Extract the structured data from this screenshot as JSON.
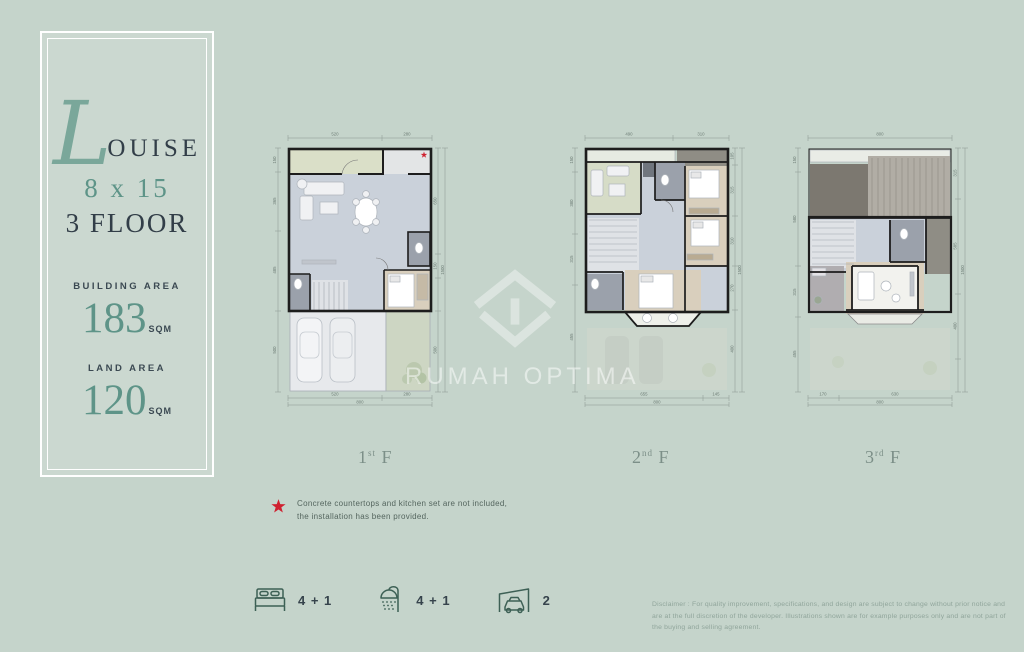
{
  "panel": {
    "title_initial": "L",
    "title_rest": "OUISE",
    "size": "8 x 15",
    "floors_line": "3 FLOOR",
    "building_area_label": "BUILDING AREA",
    "building_area_value": "183",
    "building_area_unit": "SQM",
    "land_area_label": "LAND AREA",
    "land_area_value": "120",
    "land_area_unit": "SQM"
  },
  "watermark": {
    "brand": "RUMAH OPTIMA"
  },
  "floors": [
    {
      "num": "1",
      "sup": "st",
      "f": "F",
      "dims": {
        "top": [
          "520",
          "280"
        ],
        "bottom": [
          "520",
          "280"
        ],
        "bottom_total": "800",
        "left": [
          "150",
          "365",
          "485",
          "500"
        ],
        "right": [
          "650",
          "150",
          "500"
        ],
        "right_total": "1500"
      }
    },
    {
      "num": "2",
      "sup": "nd",
      "f": "F",
      "dims": {
        "top": [
          "490",
          "310"
        ],
        "bottom": [
          "655",
          "145"
        ],
        "bottom_total": "800",
        "left": [
          "150",
          "380",
          "315",
          "455"
        ],
        "right": [
          "105",
          "315",
          "310",
          "270",
          "400"
        ],
        "right_total": "1500"
      }
    },
    {
      "num": "3",
      "sup": "rd",
      "f": "F",
      "dims": {
        "top": [
          "800"
        ],
        "bottom": [
          "170",
          "630"
        ],
        "bottom_total": "800",
        "left": [
          "150",
          "580",
          "315",
          "455"
        ],
        "right": [
          "315",
          "585",
          "400"
        ],
        "right_total": "1500"
      }
    }
  ],
  "footnote": {
    "line1": "Concrete countertops and kitchen set are not included,",
    "line2": "the installation has been provided."
  },
  "amenities": {
    "bed": "4 + 1",
    "shower": "4 + 1",
    "car": "2"
  },
  "disclaimer": "Disclaimer : For quality improvement, specifications, and design are subject to change without prior notice and are at the full discretion of the developer. Illustrations shown are for example purposes only and are not part of the buying and selling agreement.",
  "colors": {
    "background": "#c5d4cb",
    "accent_teal": "#5e9488",
    "dark_text": "#323e48",
    "wall": "#1d1d1d",
    "star_red": "#cf2130",
    "watermark_white": "rgba(255,255,255,0.5)"
  }
}
